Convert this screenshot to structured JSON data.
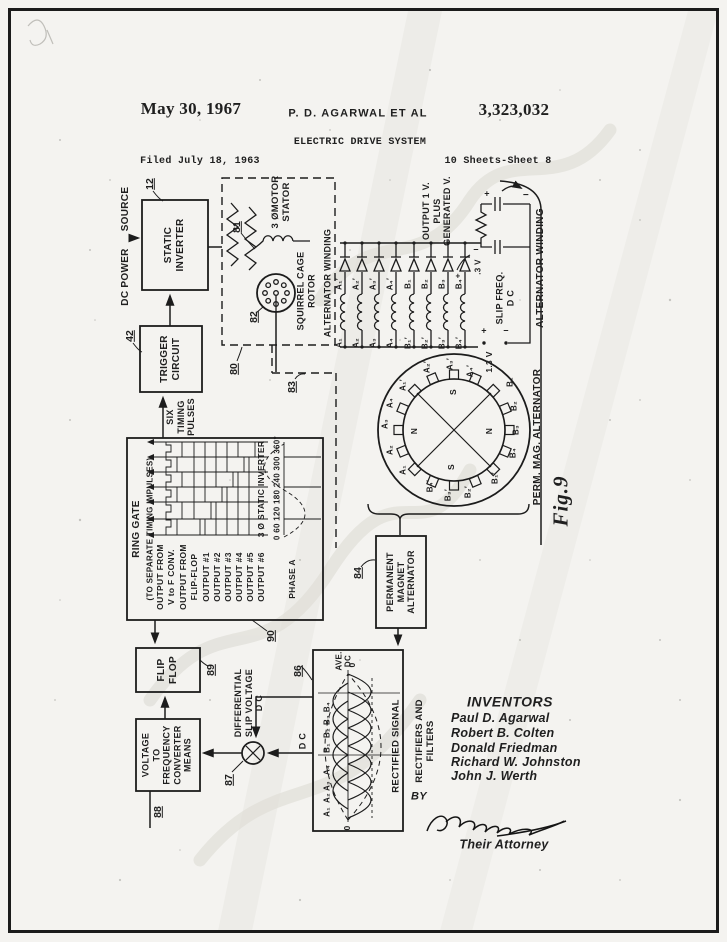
{
  "header": {
    "date": "May 30, 1967",
    "author": "P. D. AGARWAL ET AL",
    "patent_number": "3,323,032",
    "title": "ELECTRIC DRIVE SYSTEM",
    "filed": "Filed July 18, 1963",
    "sheet": "10 Sheets-Sheet 8"
  },
  "fig": "Fig.9",
  "labels": {
    "dc_power": "DC POWER",
    "source": "SOURCE",
    "static_inverter": "STATIC\nINVERTER",
    "trigger": "TRIGGER\nCIRCUIT",
    "six_timing": "SIX\nTIMING\nPULSES",
    "motor_stator": "3 ØMOTOR\nSTATOR",
    "squirrel": "SQUIRREL CAGE\nROTOR",
    "alt_winding_left": "ALTERNATOR WINDING",
    "alt_winding_right": "ALTERNATOR WINDING",
    "perm_mag": "PERM. MAG. ALTERNATOR",
    "pm_box": "PERMANENT\nMAGNET\nALTERNATOR",
    "flip_flop": "FLIP\nFLOP",
    "vf": "VOLTAGE\nTO\nFREQUENCY\nCONVERTER\nMEANS",
    "diff": "DIFFERENTIAL\nSLIP VOLTAGE\nD C",
    "dc": "D C",
    "rect_signal": "RECTIFIED SIGNAL",
    "rect_filters": "RECTIFIERS AND\nFILTERS",
    "ave": "AVE.\nDC",
    "zero": "0",
    "output_v": "OUTPUT 1 V.\nPLUS\nGENERATED V.",
    "slip_freq": "SLIP FREQ.\nD C",
    "v13": "1.3 V",
    "v03": ".3 V",
    "plus": "+",
    "minus": "−"
  },
  "ring": {
    "title": "RING GATE",
    "sep": "(TO SEPARATE TIMING IMPULSES)",
    "rows": [
      "OUTPUT FROM",
      "V to F CONV.",
      "OUTPUT FROM",
      "FLIP-FLOP"
    ],
    "outputs": [
      "OUTPUT #1",
      "OUTPUT #2",
      "OUTPUT #3",
      "OUTPUT #4",
      "OUTPUT #5",
      "OUTPUT #6"
    ],
    "inverter": "3 Ø STATIC INVERTER",
    "degrees": "0 60 120 180 240 300 360°",
    "phase": "PHASE A"
  },
  "refs": {
    "12": "12",
    "42": "42",
    "80": "80",
    "81": "81",
    "82": "82",
    "83": "83",
    "84": "84",
    "86": "86",
    "87": "87",
    "88": "88",
    "89": "89",
    "90": "90"
  },
  "dio": {
    "top": [
      "A₁′",
      "A₂′",
      "A₃′",
      "A₄′",
      "B₁",
      "B₂",
      "B₃",
      "B₄"
    ],
    "bot": [
      "A₁",
      "A₂",
      "A₃",
      "A₄",
      "B₁′",
      "B₂′",
      "B₃′",
      "B₄′"
    ]
  },
  "rotor": {
    "ring": [
      "A₁′",
      "A₂′",
      "A₃′",
      "A₄′",
      "B₁",
      "B₂",
      "B₃",
      "B₄",
      "B₁′",
      "B₂′",
      "B₃′",
      "B₄′",
      "A₁",
      "A₂",
      "A₃",
      "A₄"
    ],
    "poles": [
      "S",
      "N",
      "N",
      "S"
    ]
  },
  "wave": [
    "A₁",
    "A₂",
    "A₃",
    "A₄",
    "B₁",
    "B₂",
    "B₃",
    "B₄"
  ],
  "inventors": {
    "heading": "INVENTORS",
    "names": [
      "Paul D. Agarwal",
      "Robert B. Colten",
      "Donald Friedman",
      "Richard W. Johnston",
      "John J. Werth"
    ],
    "by": "BY",
    "attorney": "Their Attorney"
  }
}
